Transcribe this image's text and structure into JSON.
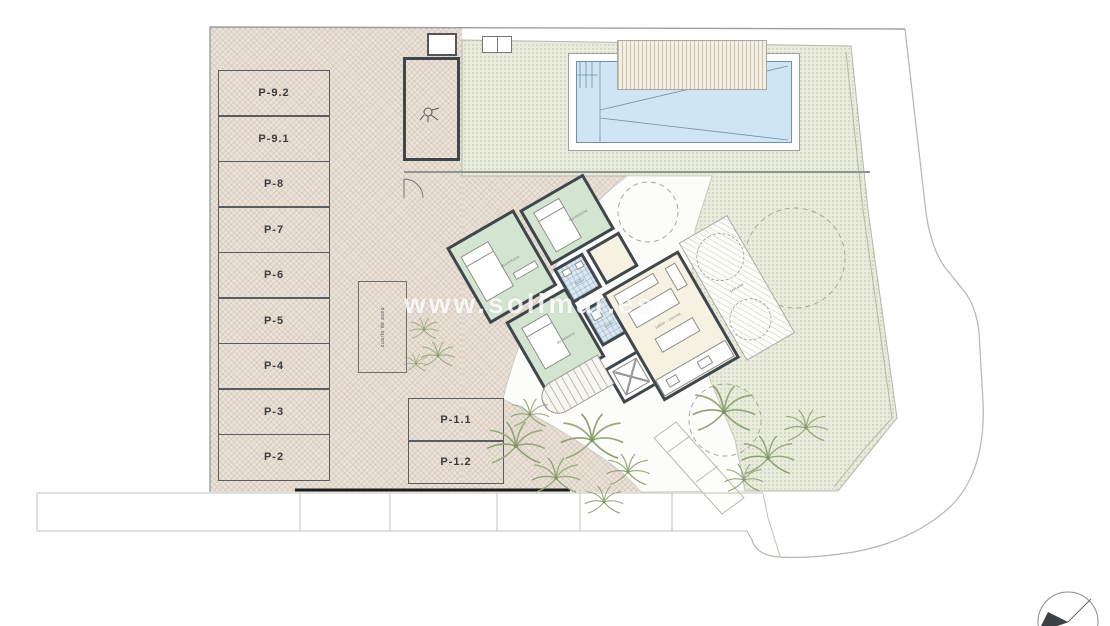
{
  "plan": {
    "watermark": "www.solimar.es",
    "parking_left": [
      "P-9.2",
      "P-9.1",
      "P-8",
      "P-7",
      "P-6",
      "P-5",
      "P-4",
      "P-3",
      "P-2"
    ],
    "parking_bottom": [
      "P-1.1",
      "P-1.2"
    ],
    "storage_label": "cuarto de aseo",
    "house": {
      "bedroom1": "dormitorio",
      "bedroom2": "dormitorio",
      "bedroom3": "dormitorio",
      "bath1": "baño",
      "bath2": "baño",
      "living": "salón - cocina",
      "terrace": "terraza",
      "terrace_right": "terraza"
    },
    "colors": {
      "driveway_hatch": "#eae2d9",
      "terrace_dots": "#e9ebdc",
      "pool_water": "#cfe5f3",
      "pool_edge": "#7291a8",
      "bedroom_green": "#d3e4d0",
      "bath_blue": "#dce8f1",
      "living_cream": "#f6f1e0",
      "wall_dark": "#3f464c",
      "palm_green": "#96a87c"
    }
  }
}
